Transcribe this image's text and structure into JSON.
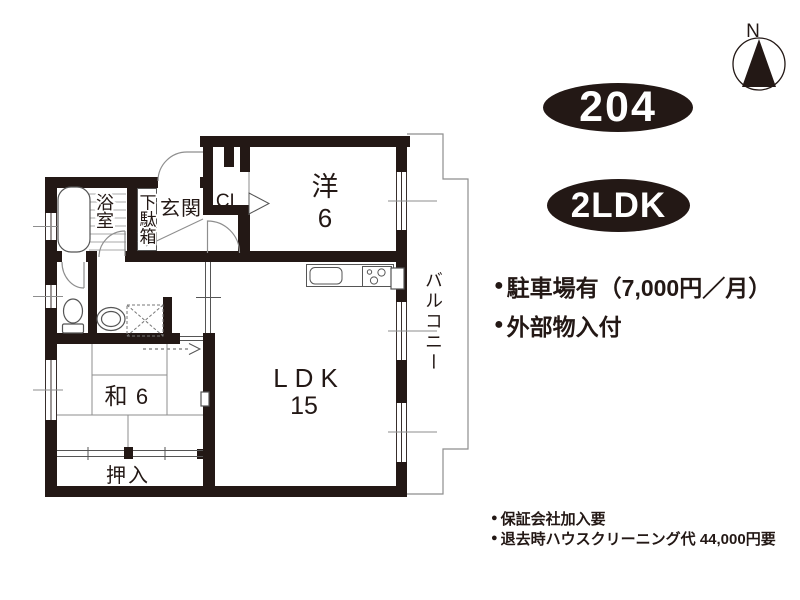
{
  "unit": {
    "number": "204",
    "layout": "2LDK"
  },
  "compass": {
    "label": "N"
  },
  "highlights": {
    "bullet": "●",
    "items": [
      "駐車場有（7,000円／月）",
      "外部物入付"
    ]
  },
  "notes": {
    "bullet": "●",
    "items": [
      "保証会社加入要",
      "退去時ハウスクリーニング代 44,000円要"
    ]
  },
  "floor_plan": {
    "rooms": {
      "western": {
        "name": "洋",
        "size": "6"
      },
      "ldk": {
        "name": "LDK",
        "size": "15"
      },
      "japanese": {
        "name": "和",
        "size": "6"
      },
      "oshiire": {
        "name": "押入"
      },
      "closet": {
        "name": "CL"
      },
      "genkan": {
        "name": "玄関"
      },
      "getabako": {
        "name": "下駄箱"
      },
      "bathroom": {
        "name": "浴室"
      },
      "balcony": {
        "name": "バルコニー"
      }
    }
  },
  "colors": {
    "ink": "#231815",
    "thin_line": "#8e8e8e",
    "fixture_line": "#555555",
    "badge_background": "#231815",
    "badge_text": "#ffffff"
  }
}
